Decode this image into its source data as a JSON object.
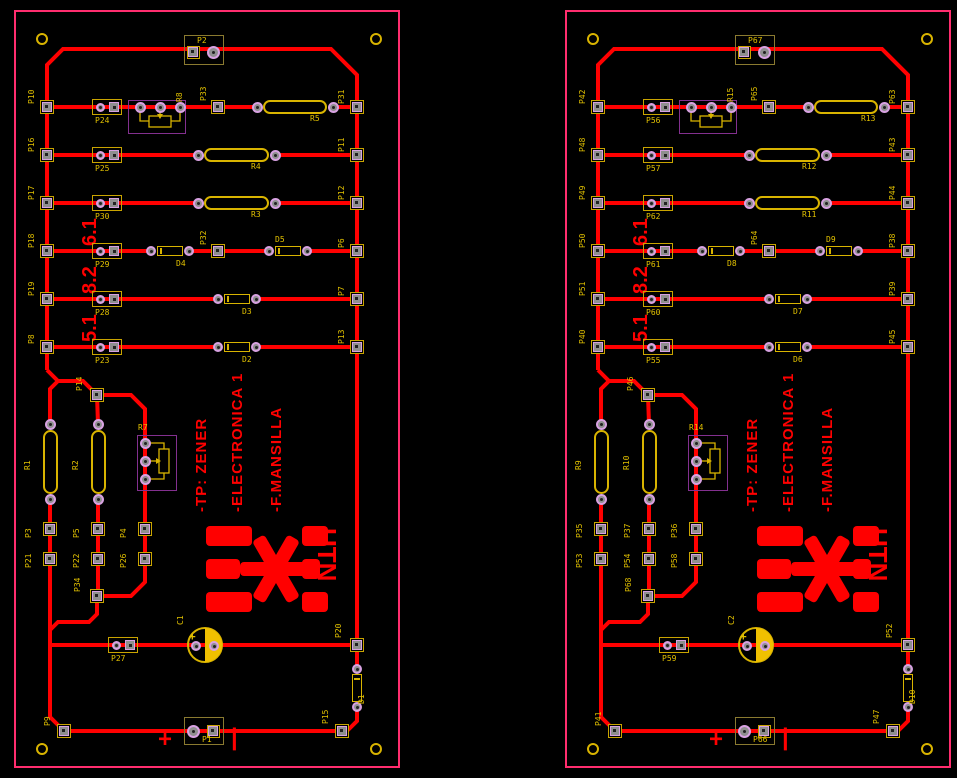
{
  "colors": {
    "background": "#000000",
    "trace": "#ff0000",
    "board_outline": "#ff2d6e",
    "silkscreen_yellow": "#e2c100",
    "component_yellow": "#d9b400",
    "pad_ring_violet": "#d8a2e2",
    "courtyard_purple": "#83308f",
    "cap_fill": "#f0c000",
    "text_red": "#ff0000"
  },
  "boards": [
    {
      "id": "pcb-board-left",
      "top_connector": "P2",
      "rows": [
        {
          "left": "P10",
          "header": "P24",
          "trimmer": "R8",
          "mid_pad": "P33",
          "resistor": "R5",
          "right": "P31"
        },
        {
          "left": "P16",
          "header": "P25",
          "resistor": "R4",
          "right": "P11"
        },
        {
          "left": "P17",
          "header": "P30",
          "resistor": "R3",
          "right": "P12",
          "value": "6.1"
        },
        {
          "left": "P18",
          "header": "P29",
          "diode_a": "D4",
          "mid_pad": "P32",
          "diode_b": "D5",
          "right": "P6",
          "value": "8.2"
        },
        {
          "left": "P19",
          "header": "P28",
          "diode": "D3",
          "right": "P7",
          "value": "5.1"
        },
        {
          "left": "P8",
          "header": "P23",
          "diode": "D2",
          "right": "P13"
        }
      ],
      "middle": {
        "top_pad": "P14",
        "resistor_a": "R1",
        "resistor_b": "R2",
        "trimmer": "R7",
        "pads_top": [
          "P3",
          "P5",
          "P4"
        ],
        "pads_bottom": [
          "P21",
          "P22",
          "P26"
        ],
        "bottom_pad": "P34"
      },
      "bottom": {
        "header": "P27",
        "capacitor": "C1",
        "right_pad": "P20",
        "diode": "D1",
        "left_pad": "P9",
        "connector": "P1",
        "corner_pad": "P15",
        "plus": "+",
        "minus": "|"
      },
      "silkscreen": {
        "line1": "-TP: ZENER",
        "line2": "-ELECTRONICA 1",
        "line3": "-F.MANSILLA",
        "logo_text": "UTN"
      }
    },
    {
      "id": "pcb-board-right",
      "top_connector": "P67",
      "rows": [
        {
          "left": "P42",
          "header": "P56",
          "trimmer": "R15",
          "mid_pad": "P65",
          "resistor": "R13",
          "right": "P63"
        },
        {
          "left": "P48",
          "header": "P57",
          "resistor": "R12",
          "right": "P43"
        },
        {
          "left": "P49",
          "header": "P62",
          "resistor": "R11",
          "right": "P44",
          "value": "6.1"
        },
        {
          "left": "P50",
          "header": "P61",
          "diode_a": "D8",
          "mid_pad": "P64",
          "diode_b": "D9",
          "right": "P38",
          "value": "8.2"
        },
        {
          "left": "P51",
          "header": "P60",
          "diode": "D7",
          "right": "P39",
          "value": "5.1"
        },
        {
          "left": "P40",
          "header": "P55",
          "diode": "D6",
          "right": "P45"
        }
      ],
      "middle": {
        "top_pad": "P46",
        "resistor_a": "R9",
        "resistor_b": "R10",
        "trimmer": "R14",
        "pads_top": [
          "P35",
          "P37",
          "P36"
        ],
        "pads_bottom": [
          "P53",
          "P54",
          "P58"
        ],
        "bottom_pad": "P68"
      },
      "bottom": {
        "header": "P59",
        "capacitor": "C2",
        "right_pad": "P52",
        "diode": "D10",
        "left_pad": "P41",
        "connector": "P66",
        "corner_pad": "P47",
        "plus": "+",
        "minus": "|"
      },
      "silkscreen": {
        "line1": "-TP: ZENER",
        "line2": "-ELECTRONICA 1",
        "line3": "-F.MANSILLA",
        "logo_text": "UTN"
      }
    }
  ]
}
